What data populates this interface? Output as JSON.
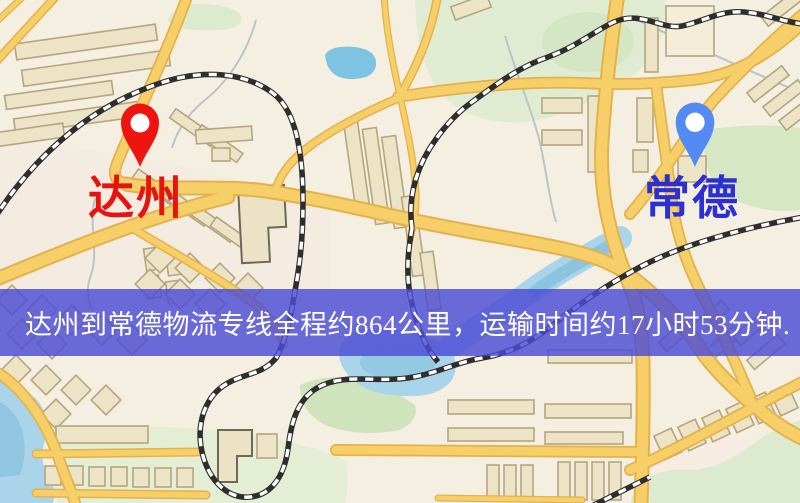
{
  "banner": {
    "text": "达州到常德物流专线全程约864公里，运输时间约17小时53分钟.",
    "bg_color": "rgba(76,76,214,0.82)",
    "text_color": "#ffffff"
  },
  "markers": [
    {
      "id": "dazhou",
      "label": "达州",
      "pin_color": "#ee1510",
      "pin_hole_color": "#ffffff",
      "label_color": "#e8120e"
    },
    {
      "id": "changde",
      "label": "常德",
      "pin_color": "#548bf2",
      "pin_hole_color": "#ffffff",
      "label_color": "#2b2fd4"
    }
  ],
  "map_palette": {
    "background": "#f5efe2",
    "district_tint": "#f3e9e0",
    "road_fill": "#f7cf68",
    "road_casing": "#e3b24c",
    "building_fill": "#ede4c8",
    "building_stroke": "#b4a67e",
    "building_stroke_dark": "#6e6957",
    "green": "#dcead0",
    "green_dark": "#cfe4bc",
    "water": "#a9d4ea",
    "water_deep": "#8cc4e0",
    "stream": "#b8c6c9",
    "railway_dark": "#2e2e2e",
    "railway_light": "#ffffff"
  }
}
